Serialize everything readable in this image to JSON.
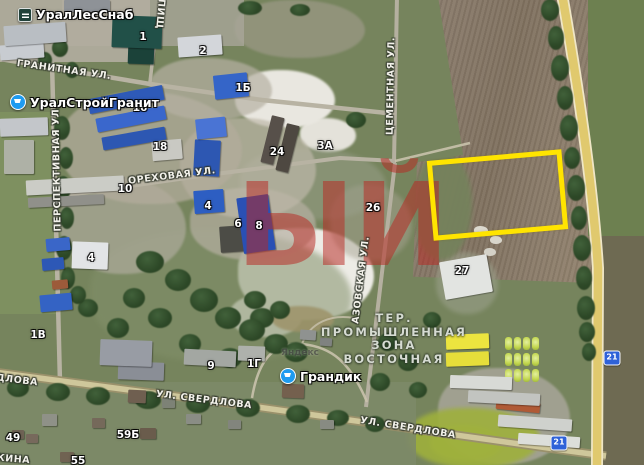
{
  "map": {
    "pois": [
      {
        "name": "urallessnab",
        "label": "УралЛесСнаб",
        "icon": "logo-square",
        "x": 18,
        "y": 7
      },
      {
        "name": "uralstroygranit",
        "label": "УралСтройГранит",
        "icon": "cart-circle",
        "x": 10,
        "y": 94
      },
      {
        "name": "grandik",
        "label": "Грандик",
        "icon": "cart-circle",
        "x": 280,
        "y": 368
      }
    ],
    "street_labels": [
      {
        "name": "granitnaya",
        "text": "Гранитная ул.",
        "cx": 64,
        "cy": 70,
        "rot": 8
      },
      {
        "name": "pishchevaya",
        "text": "пищ",
        "cx": 160,
        "cy": 14,
        "rot": 95
      },
      {
        "name": "perspektivnaya",
        "text": "Перспективная ул.",
        "cx": 57,
        "cy": 168,
        "rot": -91
      },
      {
        "name": "orekhovaya",
        "text": "Ореховая ул.",
        "cx": 172,
        "cy": 176,
        "rot": -7
      },
      {
        "name": "tsementnaya",
        "text": "Цементная ул.",
        "cx": 391,
        "cy": 86,
        "rot": -89
      },
      {
        "name": "azovskaya",
        "text": "Азовская ул.",
        "cx": 361,
        "cy": 280,
        "rot": -83
      },
      {
        "name": "sverdlova-west",
        "text": "ул. Свердлова",
        "cx": -10,
        "cy": 377,
        "rot": 7
      },
      {
        "name": "sverdlova-center",
        "text": "ул. Свердлова",
        "cx": 204,
        "cy": 400,
        "rot": 7
      },
      {
        "name": "sverdlova-east",
        "text": "ул. Свердлова",
        "cx": 408,
        "cy": 428,
        "rot": 9
      },
      {
        "name": "tkina",
        "text": "ткина",
        "cx": 10,
        "cy": 459,
        "rot": 5
      }
    ],
    "building_labels": [
      {
        "text": "1",
        "cx": 143,
        "cy": 37
      },
      {
        "text": "2",
        "cx": 203,
        "cy": 51
      },
      {
        "text": "1Б",
        "cx": 243,
        "cy": 88
      },
      {
        "text": "16",
        "cx": 140,
        "cy": 108
      },
      {
        "text": "18",
        "cx": 160,
        "cy": 147
      },
      {
        "text": "24",
        "cx": 277,
        "cy": 152
      },
      {
        "text": "3А",
        "cx": 325,
        "cy": 146
      },
      {
        "text": "10",
        "cx": 125,
        "cy": 189
      },
      {
        "text": "4",
        "cx": 208,
        "cy": 206
      },
      {
        "text": "6",
        "cx": 238,
        "cy": 224
      },
      {
        "text": "8",
        "cx": 259,
        "cy": 226
      },
      {
        "text": "4",
        "cx": 91,
        "cy": 258
      },
      {
        "text": "26",
        "cx": 373,
        "cy": 208
      },
      {
        "text": "27",
        "cx": 462,
        "cy": 271
      },
      {
        "text": "9",
        "cx": 211,
        "cy": 366
      },
      {
        "text": "1Г",
        "cx": 254,
        "cy": 364
      },
      {
        "text": "1В",
        "cx": 38,
        "cy": 335
      },
      {
        "text": "49",
        "cx": 13,
        "cy": 438
      },
      {
        "text": "59Б",
        "cx": 128,
        "cy": 435
      },
      {
        "text": "55",
        "cx": 78,
        "cy": 461
      }
    ],
    "zone_label": {
      "cx": 394,
      "top": 312,
      "lines": [
        "ТЕР.",
        "ПРОМЫШЛЕННАЯ",
        "ЗОНА",
        "ВОСТОЧНАЯ"
      ]
    },
    "watermarks": {
      "red_text": "ЫЙ",
      "provider": "Яндекс"
    },
    "road_badges": [
      {
        "text": "21",
        "cx": 559,
        "cy": 443
      },
      {
        "text": "21",
        "cx": 612,
        "cy": 358
      }
    ],
    "selection_box": {
      "x": 430,
      "y": 155,
      "w": 135,
      "h": 80,
      "rot": -5,
      "color": "#ffe400"
    }
  }
}
